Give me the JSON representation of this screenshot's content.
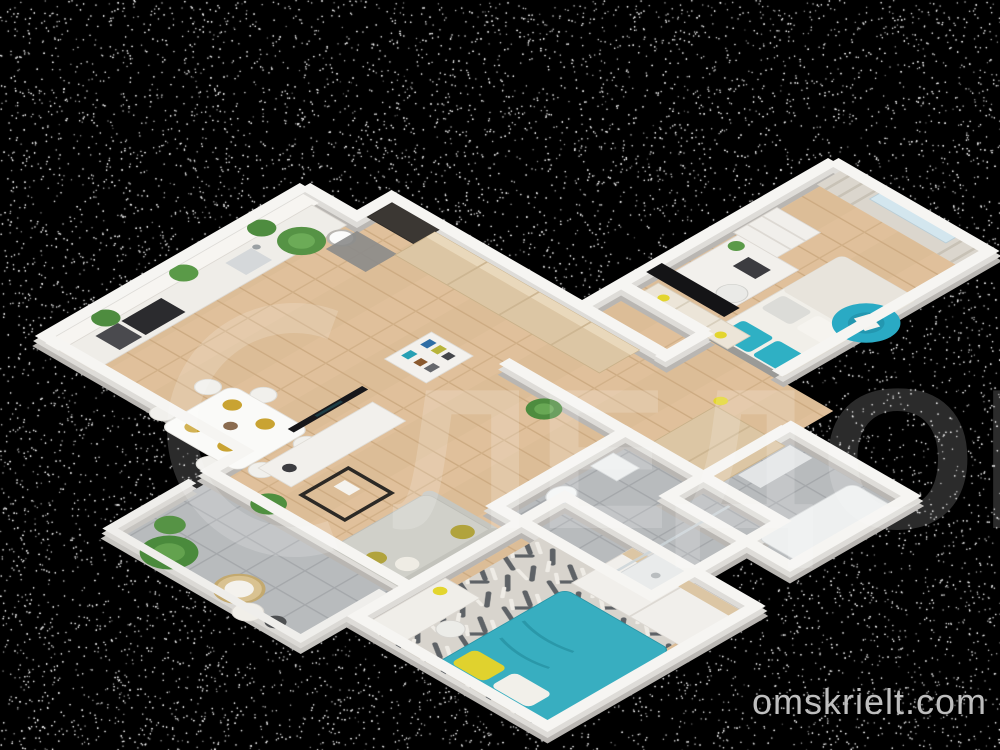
{
  "watermarks": {
    "site_text": "omskrielt.com",
    "site_color": "#c9c9c9",
    "logo_text": "ЛЕДОН",
    "logo_color": "#ffffff"
  },
  "palette": {
    "background": "#000000",
    "speckle": "#ffffff",
    "wall_top": "#f6f5f2",
    "wall_side": "#b9b6b2",
    "wood_floor": "#e0c09b",
    "tile_floor": "#b8bbbd",
    "accent_teal": "#2fb0c4",
    "accent_yellow": "#e3d52e",
    "furniture_wood": "#dcc6a4",
    "furniture_white": "#f1efeb",
    "sofa_gray": "#d0d0c9",
    "plant_green": "#4e8c3f",
    "door_dark": "#3b3733",
    "tv_dark": "#17171a",
    "gold_plate": "#c9a332"
  },
  "scene": {
    "type": "3d-floorplan-render",
    "view": "isometric"
  }
}
